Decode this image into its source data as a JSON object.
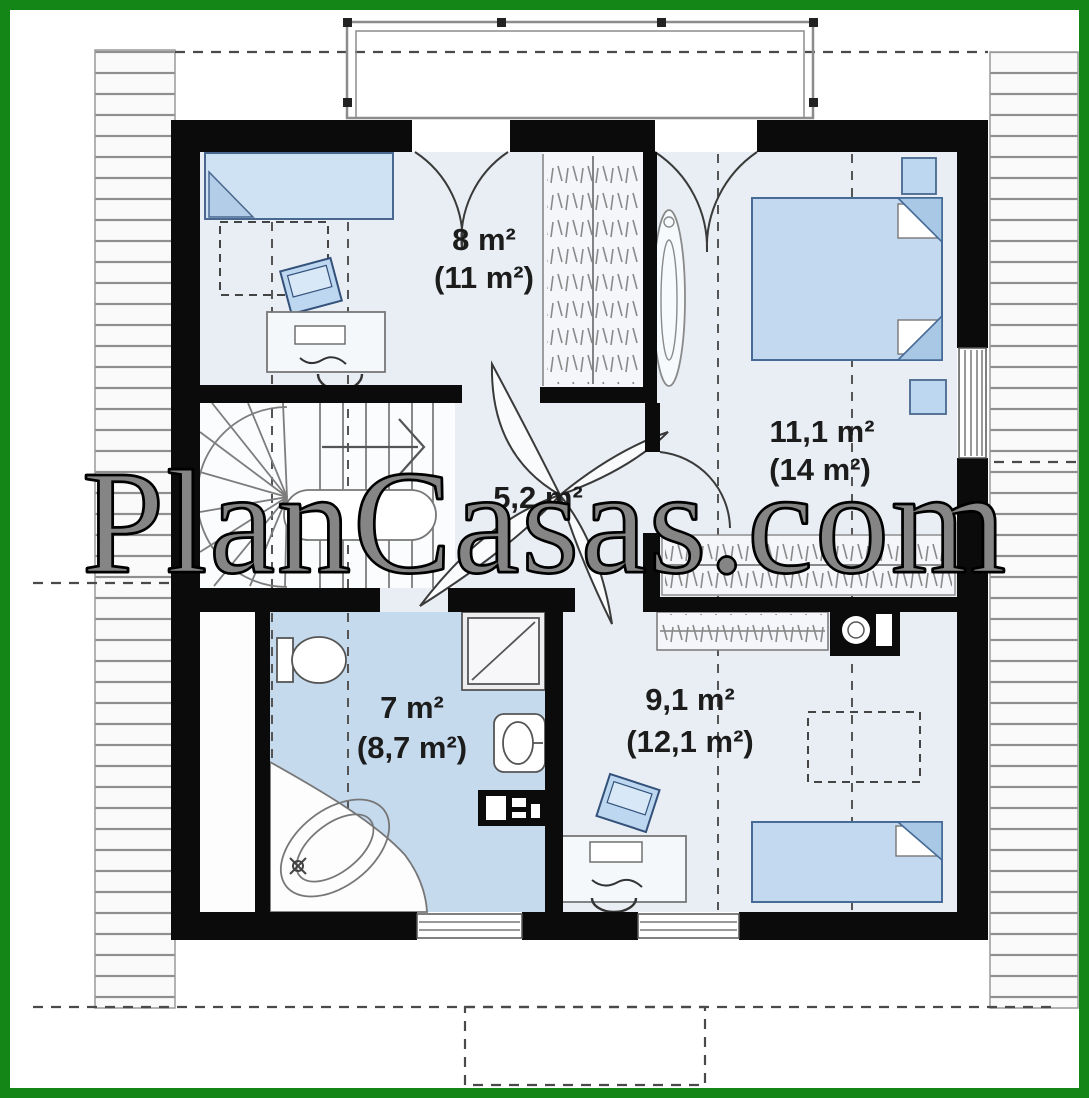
{
  "watermark": {
    "text": "PlanCasas.com"
  },
  "plan": {
    "floor_type": "attic-floor-plan",
    "rooms": [
      {
        "name": "bedroom-upper-left",
        "area_net": "8 m²",
        "area_gross": "(11 m²)"
      },
      {
        "name": "bedroom-upper-right",
        "area_net": "11,1 m²",
        "area_gross": "(14 m²)"
      },
      {
        "name": "hallway",
        "area_net": "5,2 m²",
        "area_gross": ""
      },
      {
        "name": "bathroom",
        "area_net": "7 m²",
        "area_gross": "(8,7 m²)"
      },
      {
        "name": "bedroom-lower-right",
        "area_net": "9,1 m²",
        "area_gross": "(12,1 m²)"
      }
    ],
    "colors": {
      "frame_green": "#148617",
      "wall_black": "#0b0b0b",
      "room_fill": "#e9eef4",
      "bathroom_fill": "#c6daee",
      "furniture_fill": "#c9def2",
      "bed_fill": "#c3d9ef",
      "closet_fill": "#f4f6f9",
      "hatch_line": "#8f8f8f",
      "dash_line": "#4a4a4a",
      "label_text": "#1c1c1c"
    }
  }
}
